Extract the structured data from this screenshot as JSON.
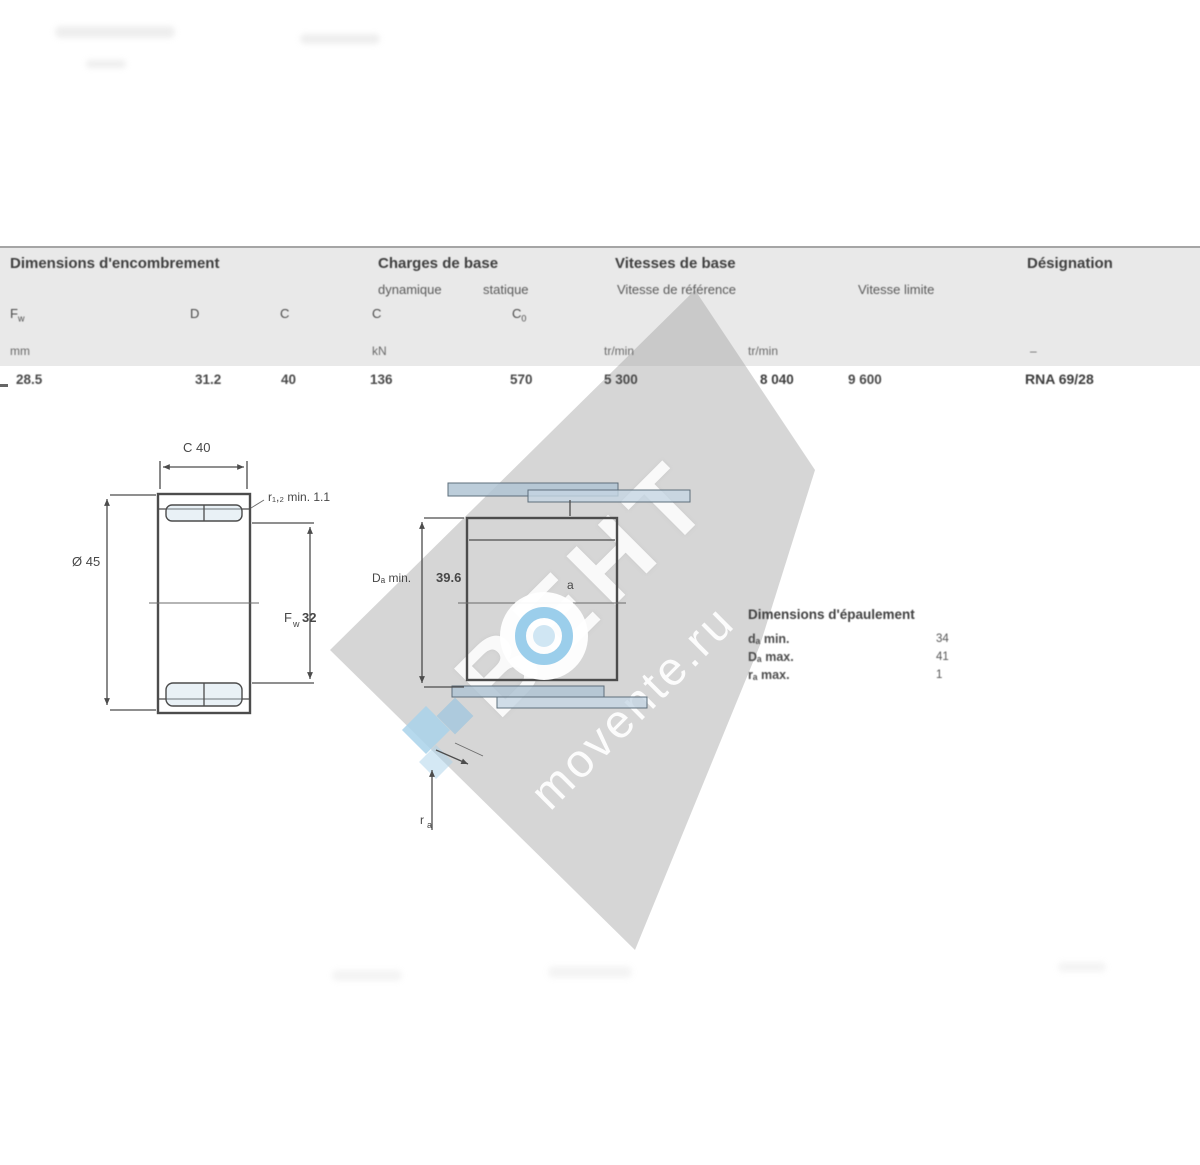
{
  "colors": {
    "band_gray": "#e9e9e9",
    "diamond_gray": "#9e9e9e",
    "logo_blue": "#8ac6e8",
    "watermark_text": "#ffffff"
  },
  "table": {
    "group_dims": "Dimensions d'encombrement",
    "group_loads": "Charges de base",
    "sub_dyn": "dynamique",
    "sub_stat": "statique",
    "group_speeds": "Vitesses de base",
    "sub_vref": "Vitesse de référence",
    "sub_vlim": "Vitesse limite",
    "group_designation": "Désignation",
    "col_fw": "F",
    "col_fw_sub": "w",
    "col_d": "D",
    "col_c": "C",
    "col_cdyn": "C",
    "col_c0": "C",
    "col_c0_sub": "0",
    "unit_mm": "mm",
    "unit_kn": "kN",
    "unit_rpm_ref": "tr/min",
    "unit_rpm_lim": "tr/min",
    "unit_des": "–",
    "val_fw": "28.5",
    "val_d": "31.2",
    "val_c": "40",
    "val_cdyn": "136",
    "val_c0": "570",
    "val_vref": "5 300",
    "val_vlim": "8 040",
    "val_vlim2": "9 600",
    "val_designation": "RNA 69/28"
  },
  "fig1": {
    "dim_top": "C 40",
    "dim_left": "Ø 45",
    "bore_sym": "F",
    "bore_sub": "w",
    "bore_val": "32",
    "note_r": "r₁,₂ min. 1.1"
  },
  "fig2": {
    "dim_housing_sym": "Dₐ min.",
    "dim_housing_val": "39.6",
    "label_a": "a",
    "ra_sym": "r",
    "ra_sub": "a"
  },
  "abutment": {
    "title": "Dimensions d'épaulement",
    "rows": [
      {
        "label": "dₐ min.",
        "value": "34"
      },
      {
        "label": "Dₐ max.",
        "value": "41"
      },
      {
        "label": "rₐ max.",
        "value": "1"
      }
    ]
  },
  "watermark": {
    "big_text": "ВЕНТ",
    "site_text": "movente.ru"
  }
}
